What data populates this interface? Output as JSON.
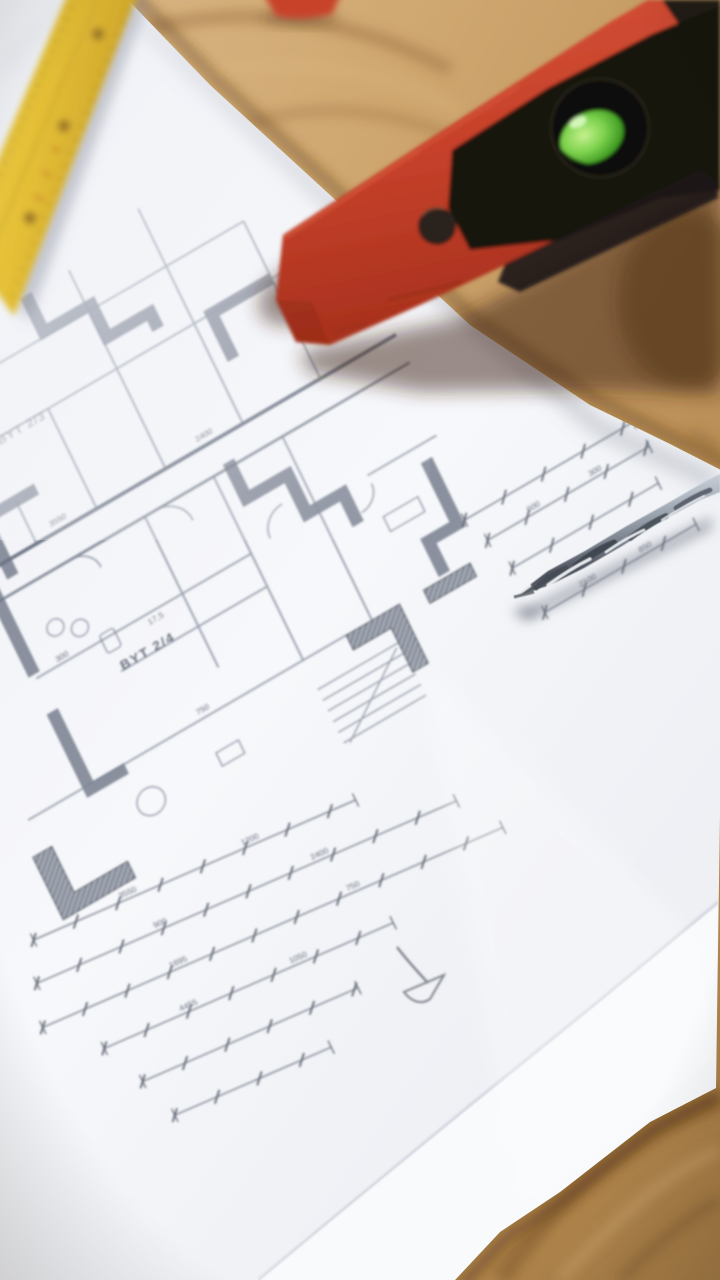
{
  "scene": {
    "description": "Architectural blueprint floor plan lying on a wooden table, photographed at an angle with shallow depth of field. A yellow folding ruler rests at the top-left, a red spirit level with a green bubble vial lies across the top-right on the wood, and a metal twist drill bit sits on the paper at center-right. A pencil scribble is drawn on the plan's empty margin.",
    "surface": "wooden table"
  },
  "plan": {
    "labels": {
      "byt_main": "BYT 2/4",
      "byt_secondary": "BYT 2/3",
      "area": "17,5"
    },
    "dimension_numbers": [
      "3550",
      "1200",
      "900",
      "2400",
      "1695",
      "750",
      "4455",
      "1050",
      "600",
      "300",
      "2100",
      "850"
    ],
    "line_color": "#6f7683",
    "wall_fill": "#7f8694",
    "paper_color": "#f4f6f9"
  },
  "objects": {
    "spirit_level": {
      "body_color": "#c6402a",
      "panel_color": "#171310",
      "bubble_color": "#55b52e"
    },
    "folding_ruler": {
      "color": "#e4bf36",
      "hinge_color": "#a8842e",
      "mark_color": "#c04a22"
    },
    "drill_bit": {
      "color": "#9aa1ac"
    },
    "red_tool_tip": {
      "color": "#c8432a"
    },
    "table_wood": {
      "color": "#c2975f"
    }
  }
}
